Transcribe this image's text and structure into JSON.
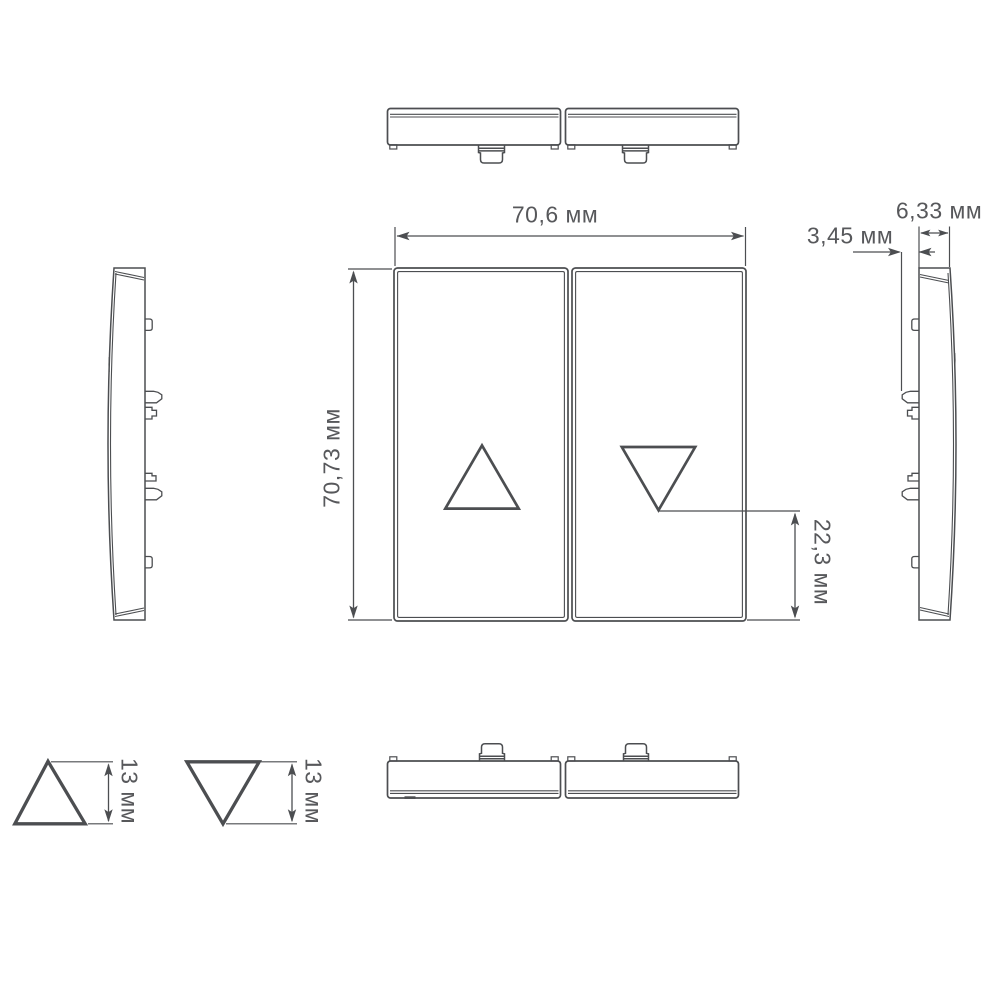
{
  "labels": {
    "top_width": "70,6 мм",
    "front_height": "70,73 мм",
    "clip_protrusion": "3,45 мм",
    "side_depth": "6,33 мм",
    "arrow_bottom_offset": "22,3 мм",
    "up_arrow_height": "13 мм",
    "down_arrow_height": "13 мм"
  },
  "icons": {
    "left_rocker": "up-triangle-icon",
    "right_rocker": "down-triangle-icon",
    "detail_left": "up-triangle-icon",
    "detail_right": "down-triangle-icon"
  },
  "colors": {
    "line": "#4c4e51",
    "text": "#57585b",
    "background": "#ffffff"
  }
}
